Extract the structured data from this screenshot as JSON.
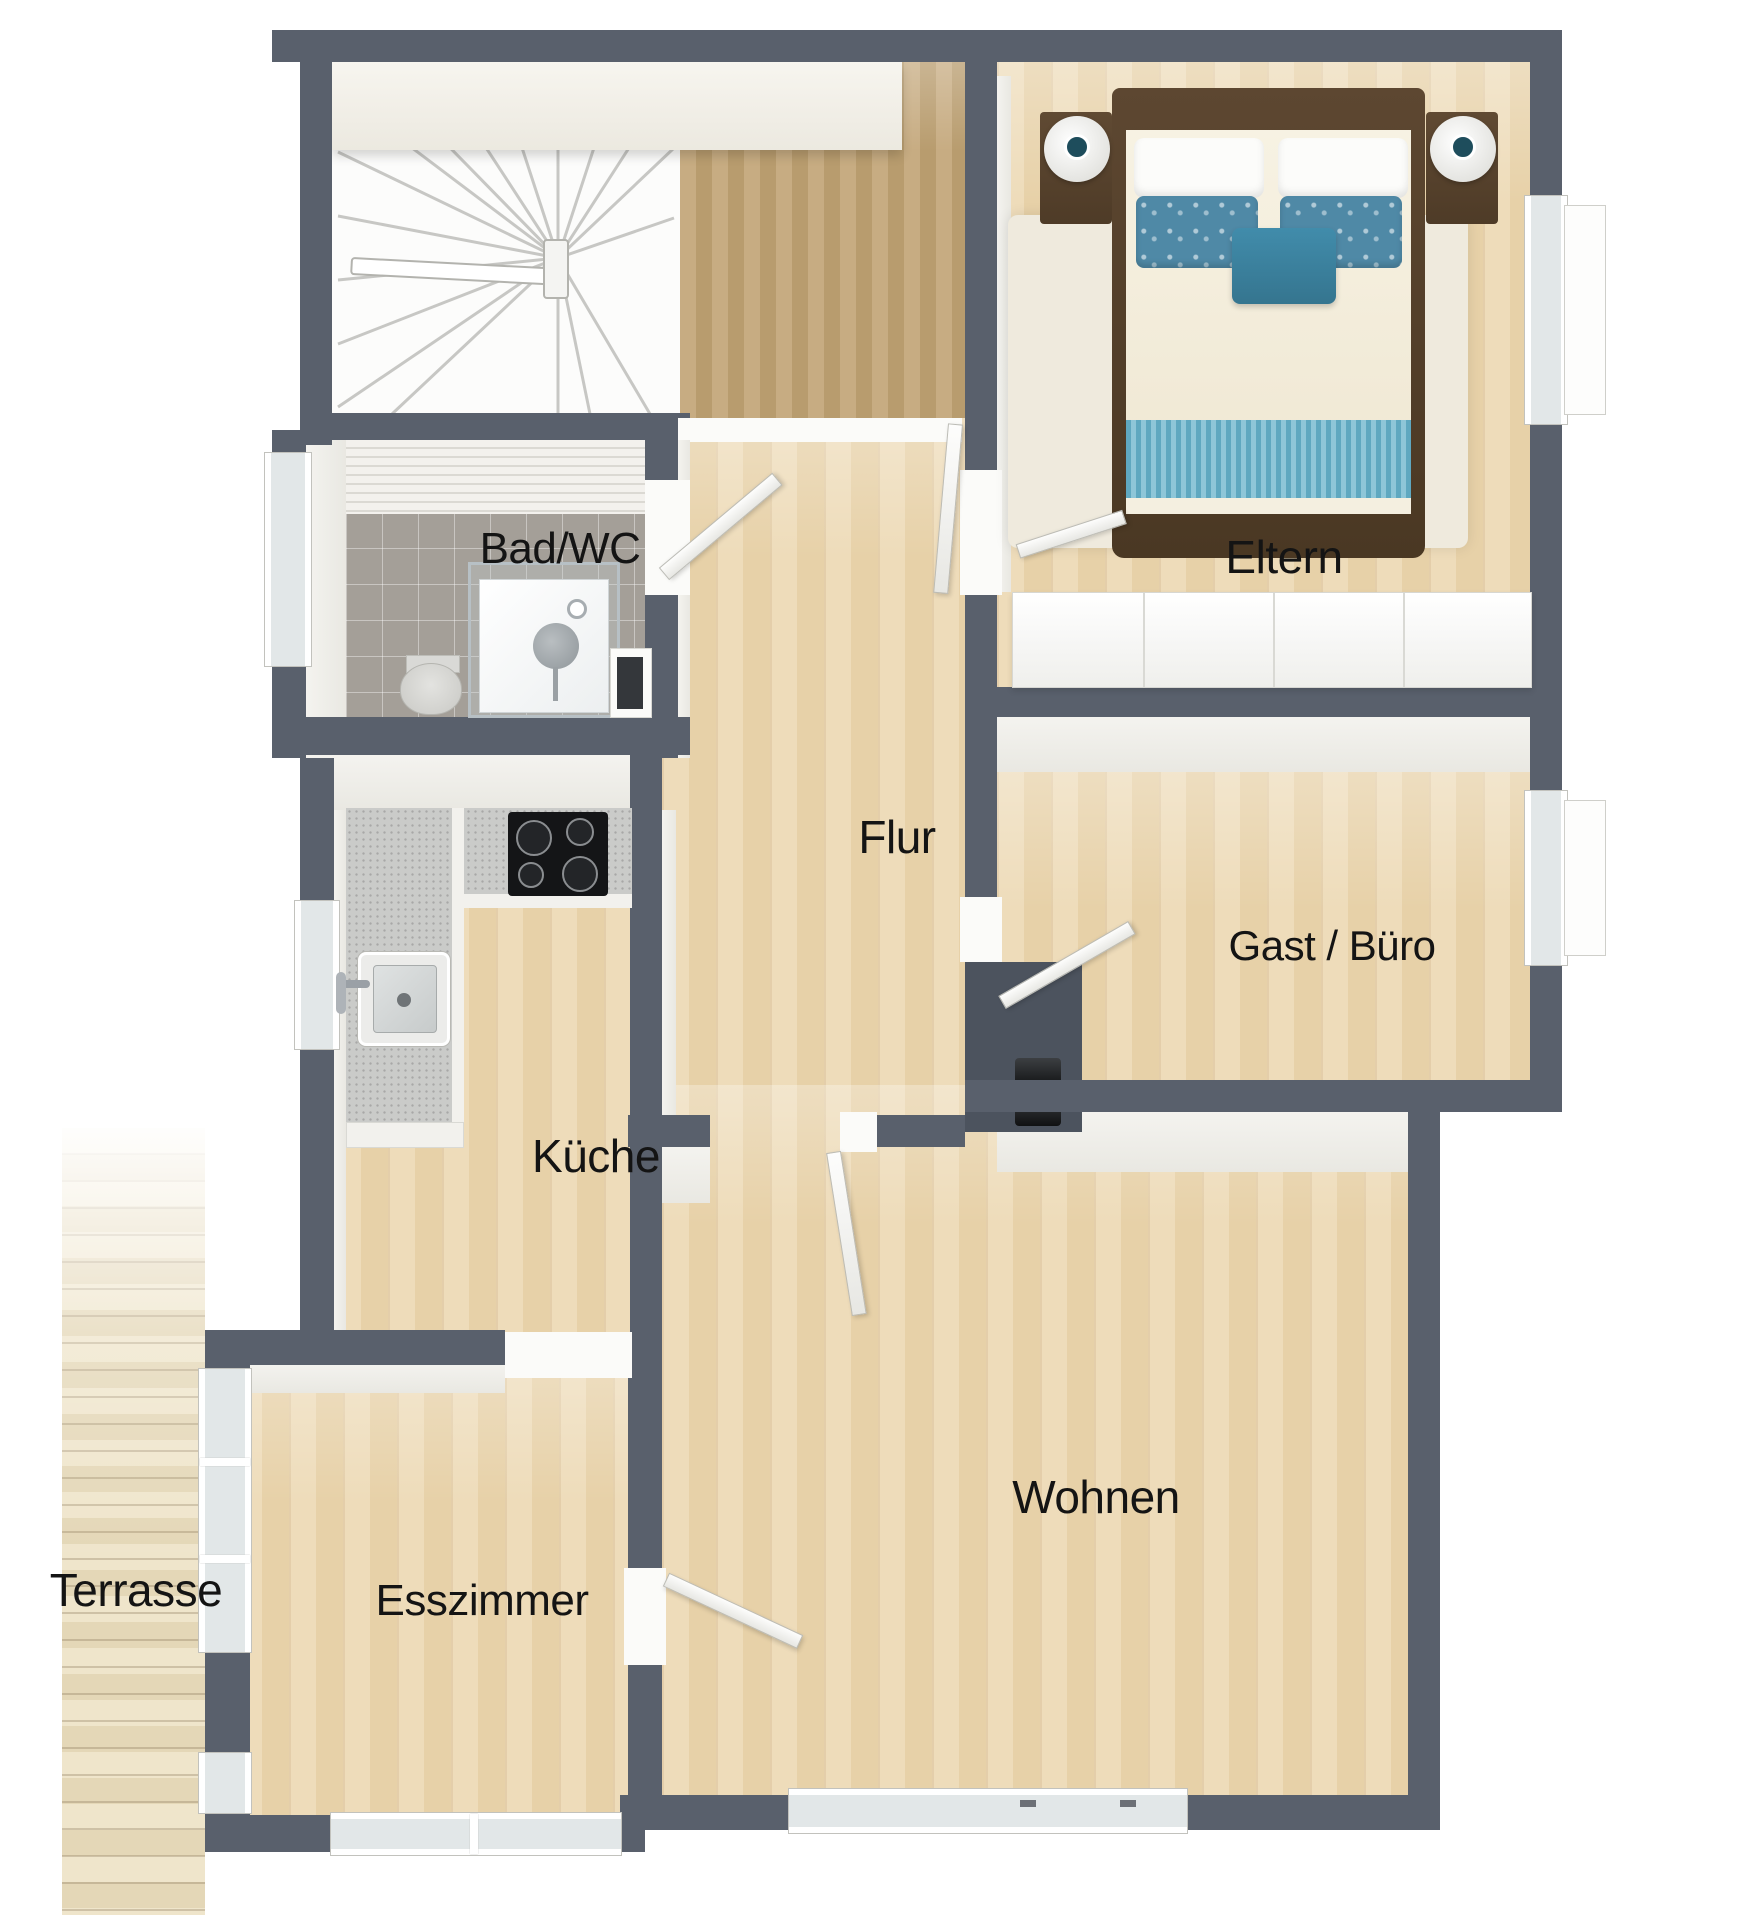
{
  "type": "3d-floor-plan-top-view",
  "rooms": {
    "bad": {
      "label": "Bad/WC"
    },
    "eltern": {
      "label": "Eltern"
    },
    "flur": {
      "label": "Flur"
    },
    "gast": {
      "label": "Gast / Büro"
    },
    "kueche": {
      "label": "Küche"
    },
    "wohnen": {
      "label": "Wohnen"
    },
    "esszimmer": {
      "label": "Esszimmer"
    },
    "terrasse": {
      "label": "Terrasse"
    }
  },
  "palette": {
    "wall": "#59606c",
    "wall_face": "#f0efeb",
    "floor_wood": "#ebd6af",
    "floor_landing": "#bda176",
    "terrace_deck": "#eee4cb",
    "bath_tile": "#a49f98",
    "kitchen_counter": "#cacbc9",
    "accent_blue": "#4a8fae",
    "bed_wood": "#53402c",
    "label_color": "#141414"
  }
}
